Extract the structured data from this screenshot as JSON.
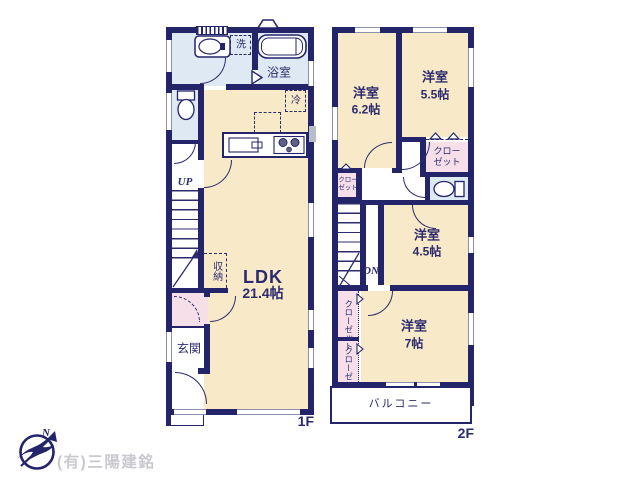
{
  "colors": {
    "wall": "#24246a",
    "room_cream": "#f8e9c8",
    "room_wet_blue": "#dfe9f3",
    "room_pink": "#f7dfe9",
    "balcony_white": "#ffffff",
    "label_navy": "#2b2b6e",
    "company_gray": "#c9c9d0"
  },
  "floor1": {
    "label": "1F",
    "laundry": "洗",
    "bath": "浴室",
    "fridge": "冷",
    "ldk_name": "LDK",
    "ldk_size": "21.4帖",
    "stairs_up": "UP",
    "storage": "収納",
    "entrance": "玄関"
  },
  "floor2": {
    "label": "2F",
    "room_62_name": "洋室",
    "room_62_size": "6.2帖",
    "room_55_name": "洋室",
    "room_55_size": "5.5帖",
    "room_45_name": "洋室",
    "room_45_size": "4.5帖",
    "room_7_name": "洋室",
    "room_7_size": "7帖",
    "closet_right": "クローゼット",
    "closet_mid_left": "クローゼット",
    "closet_low_upper": "クローゼット",
    "closet_low_lower": "クローゼット",
    "stairs_down": "DN",
    "balcony": "バルコニー"
  },
  "footer": {
    "company": "(有)三陽建銘",
    "north": "N"
  }
}
